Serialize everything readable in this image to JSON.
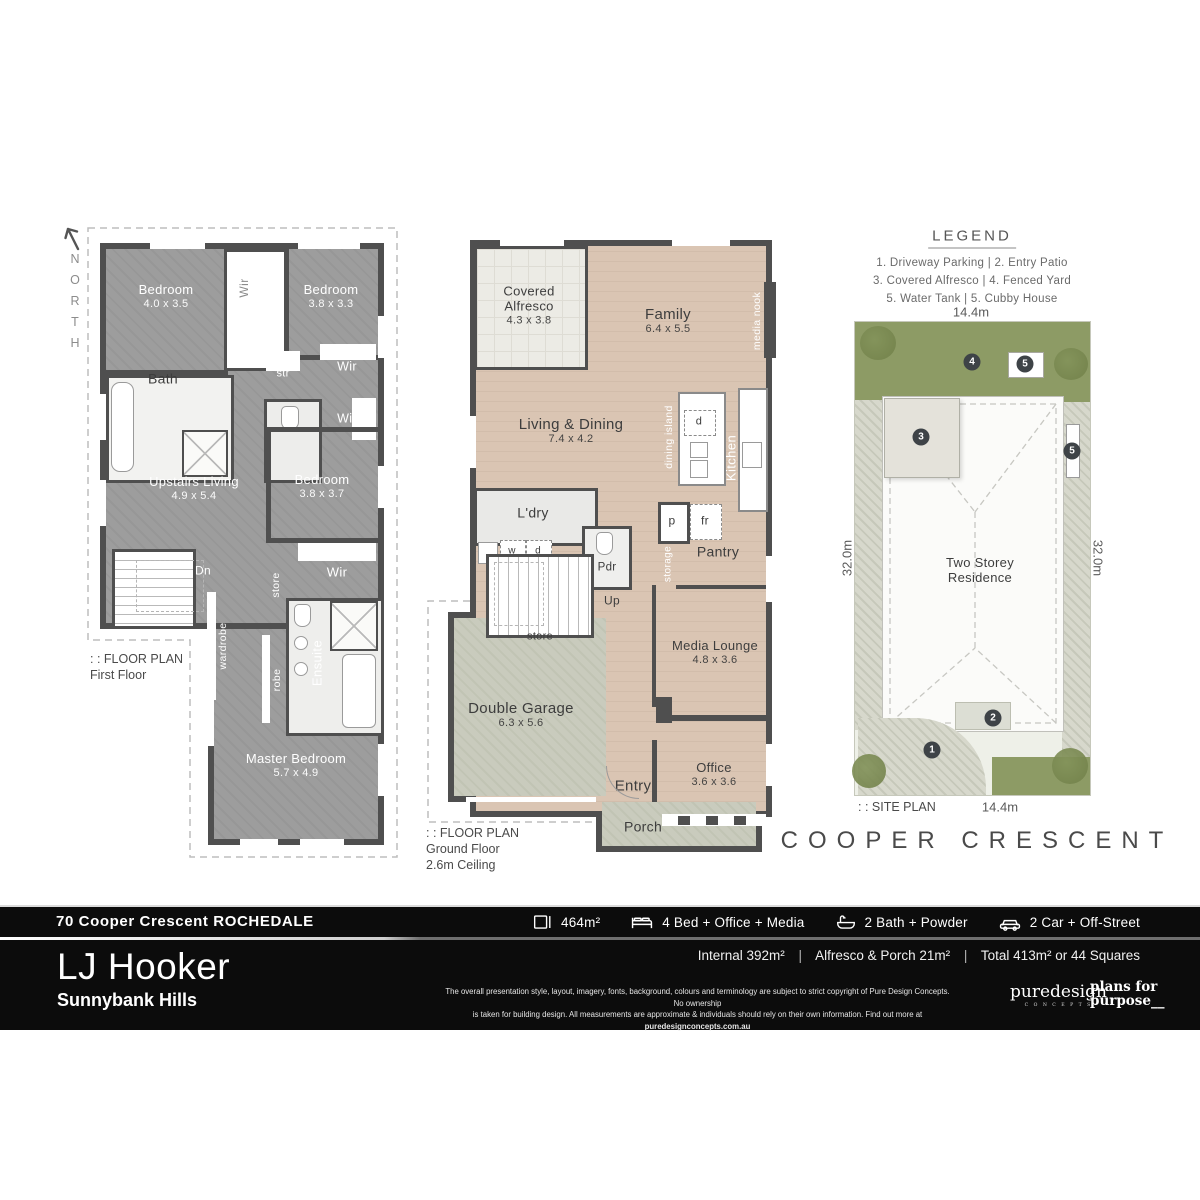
{
  "north_label": "NORTH",
  "legend": {
    "title": "LEGEND",
    "rows": [
      "1. Driveway Parking   |   2. Entry Patio",
      "3. Covered Alfresco   |   4. Fenced Yard",
      "5. Water Tank  |  5. Cubby House"
    ]
  },
  "first_floor": {
    "plan_label_prefix": ": :  FLOOR PLAN",
    "plan_label_name": "First Floor",
    "rooms": {
      "bedroom1": {
        "name": "Bedroom",
        "dim": "4.0 x 3.5"
      },
      "wir_top": "Wir",
      "bedroom2": {
        "name": "Bedroom",
        "dim": "3.8 x 3.3"
      },
      "bath": "Bath",
      "str": "str",
      "wir_r1": "Wir",
      "wir_r2": "Wir",
      "living": {
        "name": "Upstairs Living",
        "dim": "4.9 x 5.4"
      },
      "bedroom3": {
        "name": "Bedroom",
        "dim": "3.8 x 3.7"
      },
      "dn": "Dn",
      "store": "store",
      "wir_mid": "Wir",
      "wardrobe": "wardrobe",
      "robe": "robe",
      "ensuite": "Ensuite",
      "master": {
        "name": "Master Bedroom",
        "dim": "5.7 x 4.9"
      }
    }
  },
  "ground_floor": {
    "plan_label_prefix": ": :  FLOOR PLAN",
    "plan_label_name": "Ground Floor",
    "plan_label_extra": "2.6m Ceiling",
    "rooms": {
      "alfresco": {
        "name": "Covered Alfresco",
        "dim": "4.3 x 3.8"
      },
      "family": {
        "name": "Family",
        "dim": "6.4 x 5.5"
      },
      "media_nook": "media nook",
      "living": {
        "name": "Living & Dining",
        "dim": "7.4 x 4.2"
      },
      "dining_island": "dining island",
      "d": "d",
      "kitchen": "Kitchen",
      "ldry": "L'dry",
      "w": "w",
      "d2": "d",
      "pdr": "Pdr",
      "p": "p",
      "fr": "fr",
      "storage": "storage",
      "pantry": "Pantry",
      "up": "Up",
      "store": "store",
      "media_lounge": {
        "name": "Media Lounge",
        "dim": "4.8 x 3.6"
      },
      "garage": {
        "name": "Double Garage",
        "dim": "6.3 x 5.6"
      },
      "office": {
        "name": "Office",
        "dim": "3.6 x 3.6"
      },
      "entry": "Entry",
      "porch": "Porch"
    }
  },
  "site_plan": {
    "label": ": :  SITE PLAN",
    "width_top": "14.4m",
    "width_bottom": "14.4m",
    "depth_left": "32.0m",
    "depth_right": "32.0m",
    "residence_line1": "Two Storey",
    "residence_line2": "Residence",
    "street": "COOPER CRESCENT",
    "markers": {
      "m1": "1",
      "m2": "2",
      "m3": "3",
      "m4": "4",
      "m5a": "5",
      "m5b": "5"
    }
  },
  "footer": {
    "address": "70 Cooper Crescent ROCHEDALE",
    "stats": [
      {
        "icon": "area-icon",
        "label": "464m²"
      },
      {
        "icon": "bed-icon",
        "label": "4 Bed + Office + Media"
      },
      {
        "icon": "bath-icon",
        "label": "2 Bath + Powder"
      },
      {
        "icon": "car-icon",
        "label": "2 Car + Off-Street"
      }
    ],
    "areas": {
      "internal": "Internal 392m²",
      "alfresco": "Alfresco & Porch 21m²",
      "total": "Total 413m² or 44 Squares",
      "sep": "|"
    },
    "brand": "LJ Hooker",
    "office": "Sunnybank Hills",
    "disclaimer_line1": "The overall presentation style, layout, imagery, fonts, background, colours and terminology are subject to strict copyright of Pure Design Concepts. No ownership",
    "disclaimer_line2": "is taken for building design. All measurements are approximate & individuals should rely on their own information. Find out more at ",
    "disclaimer_link": "puredesignconcepts.com.au",
    "pure_brand": "puredesign",
    "pure_sub": "C O N C E P T S",
    "plans_line1": "plans for",
    "plans_line2": "purpose__"
  },
  "colors": {
    "wall": "#4f4f4f",
    "first_floor_fill": "#9c9c9c",
    "ground_floor_fill": "#d9c4b2",
    "garage_fill": "#c9cbbd",
    "grass": "#8d9b65",
    "lot": "#d7d8cc",
    "marker": "#3e4347",
    "footer_bg": "#0c0c0c"
  }
}
